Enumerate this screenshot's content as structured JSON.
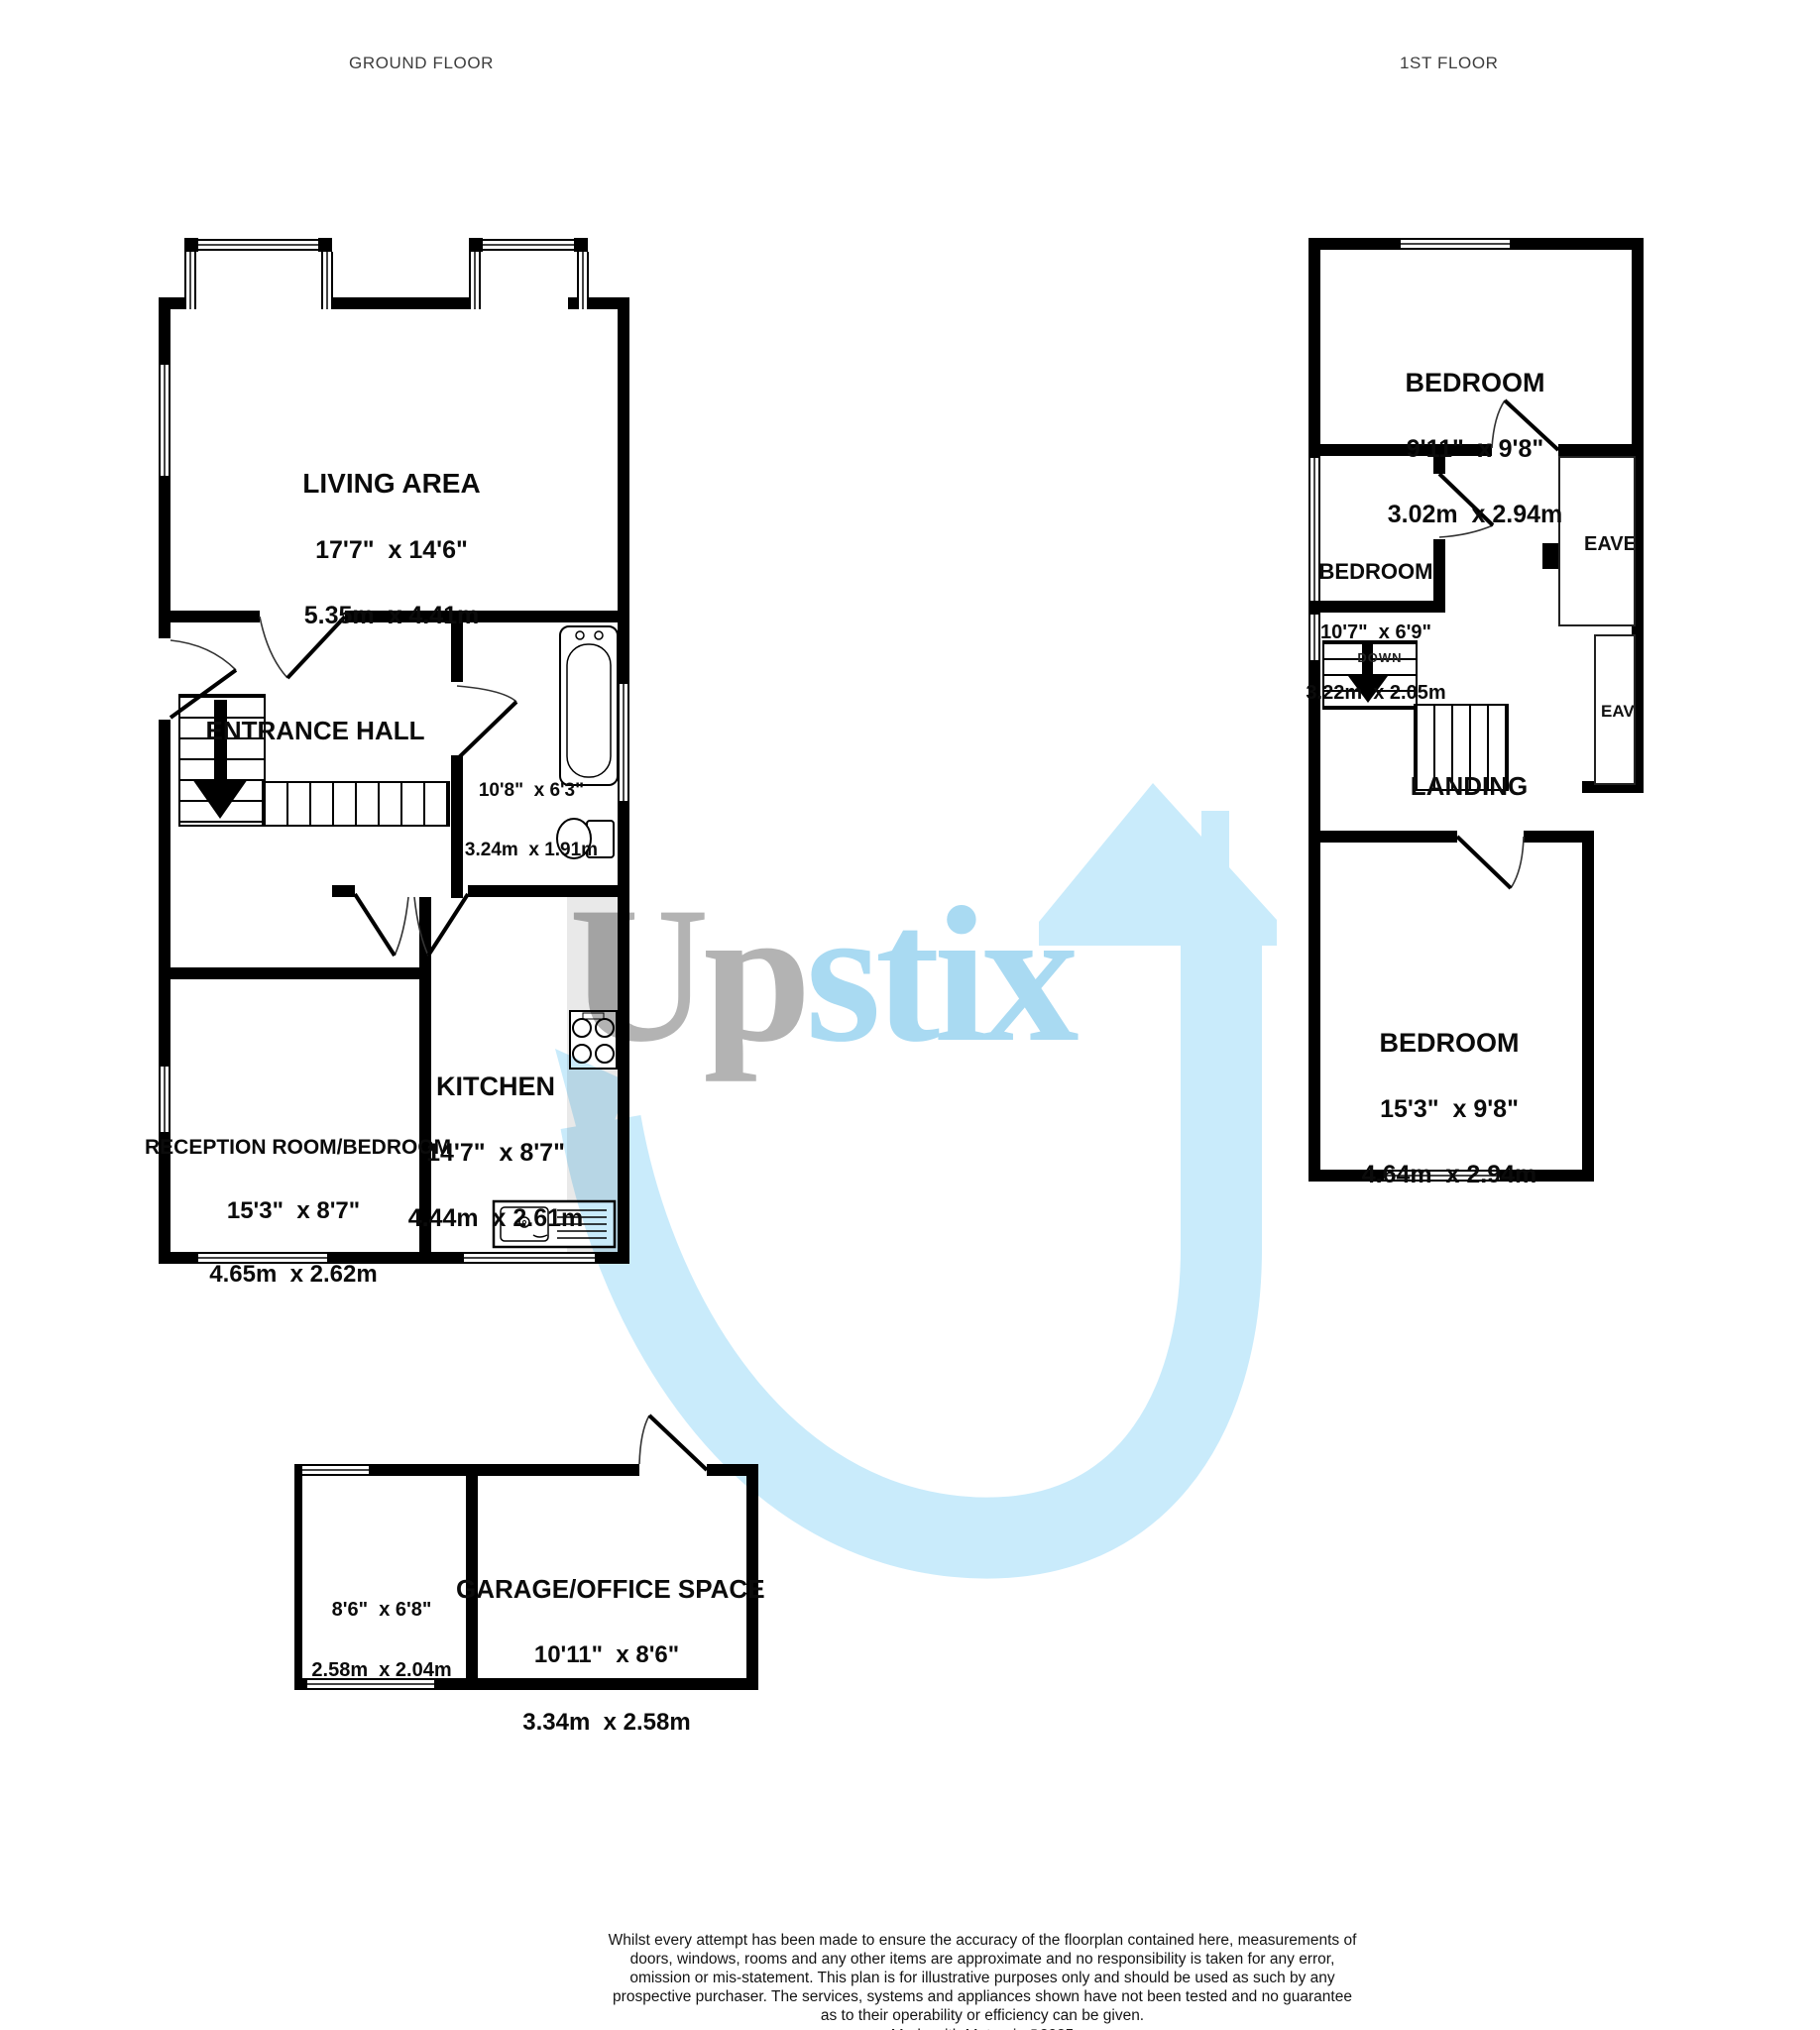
{
  "floors": {
    "ground": {
      "title": "GROUND FLOOR"
    },
    "first": {
      "title": "1ST FLOOR"
    }
  },
  "rooms": {
    "living": {
      "name": "LIVING AREA",
      "imperial": "17'7\"  x 14'6\"",
      "metric": "5.35m  x 4.41m"
    },
    "entrance": {
      "name": "ENTRANCE HALL"
    },
    "bathroom": {
      "imperial": "10'8\"  x 6'3\"",
      "metric": "3.24m  x 1.91m"
    },
    "kitchen": {
      "name": "KITCHEN",
      "imperial": "14'7\"  x 8'7\"",
      "metric": "4.44m  x 2.61m"
    },
    "reception": {
      "name": "RECEPTION ROOM/BEDROOM",
      "imperial": "15'3\"  x 8'7\"",
      "metric": "4.65m  x 2.62m"
    },
    "garage": {
      "name": "GARAGE/OFFICE SPACE",
      "imperial": "10'11\"  x 8'6\"",
      "metric": "3.34m  x 2.58m"
    },
    "garage_store": {
      "imperial": "8'6\"  x 6'8\"",
      "metric": "2.58m  x 2.04m"
    },
    "bedroom1": {
      "name": "BEDROOM",
      "imperial": "9'11\"  x 9'8\"",
      "metric": "3.02m  x 2.94m"
    },
    "bedroom2": {
      "name": "BEDROOM",
      "imperial": "10'7\"  x 6'9\"",
      "metric": "3.22m  x 2.05m"
    },
    "bedroom3": {
      "name": "BEDROOM",
      "imperial": "15'3\"  x 9'8\"",
      "metric": "4.64m  x 2.94m"
    },
    "landing": {
      "name": "LANDING"
    },
    "eaves_upper": {
      "name": "EAVES"
    },
    "eaves_lower": {
      "name": "EAVES"
    }
  },
  "stairs": {
    "down_label": "DOWN"
  },
  "watermark": {
    "brand_prefix": "Up",
    "brand_suffix": "stix",
    "gray": "#b3b3b3",
    "text_blue": "#a9daf2",
    "arrow_blue": "#c9ebfb"
  },
  "footer": {
    "disclaimer": "Whilst every attempt has been made to ensure the accuracy of the floorplan contained here, measurements of doors, windows, rooms and any other items are approximate and no responsibility is taken for any error, omission or mis-statement. This plan is for illustrative purposes only and should be used as such by any prospective purchaser. The services, systems and appliances shown have not been tested and no guarantee as to their operability or efficiency can be given.",
    "credit": "Made with Metropix ©2025"
  }
}
